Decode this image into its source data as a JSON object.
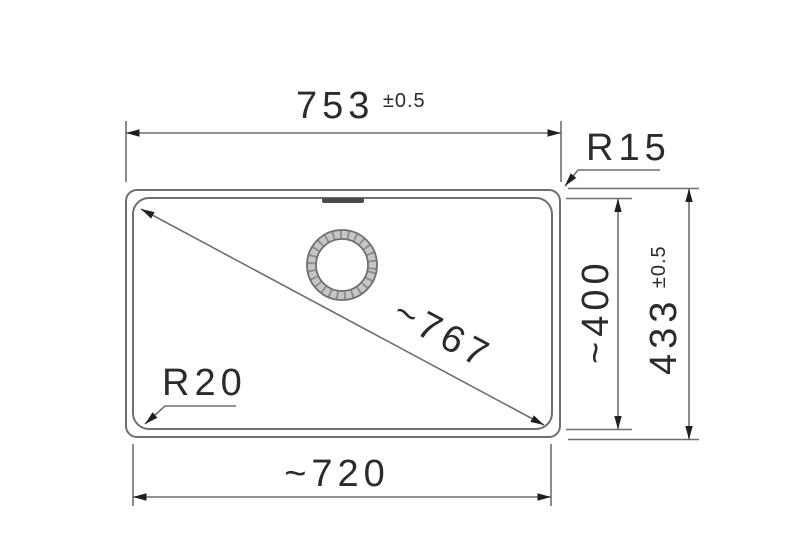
{
  "page": {
    "background": "#ffffff"
  },
  "drawing": {
    "type": "technical-dimension-drawing",
    "object": "sink-bowl-top-view",
    "colors": {
      "line": "#6f6f6f",
      "text": "#2b2b2b",
      "arrow": "#1f1f1f",
      "drain_band": "#c6c6c6",
      "drain_hatch": "#8f8f8f",
      "overflow_slot": "#4a4a4a",
      "background": "#ffffff"
    },
    "dimensions": {
      "top_width": {
        "value": "753",
        "tolerance": "±0.5"
      },
      "corner_radius_top_right": "R15",
      "inner_height": "~400",
      "outer_height": {
        "value": "433",
        "tolerance": "±0.5"
      },
      "diagonal": "~767",
      "corner_radius_bottom_left": "R20",
      "inner_width": "~720"
    }
  }
}
